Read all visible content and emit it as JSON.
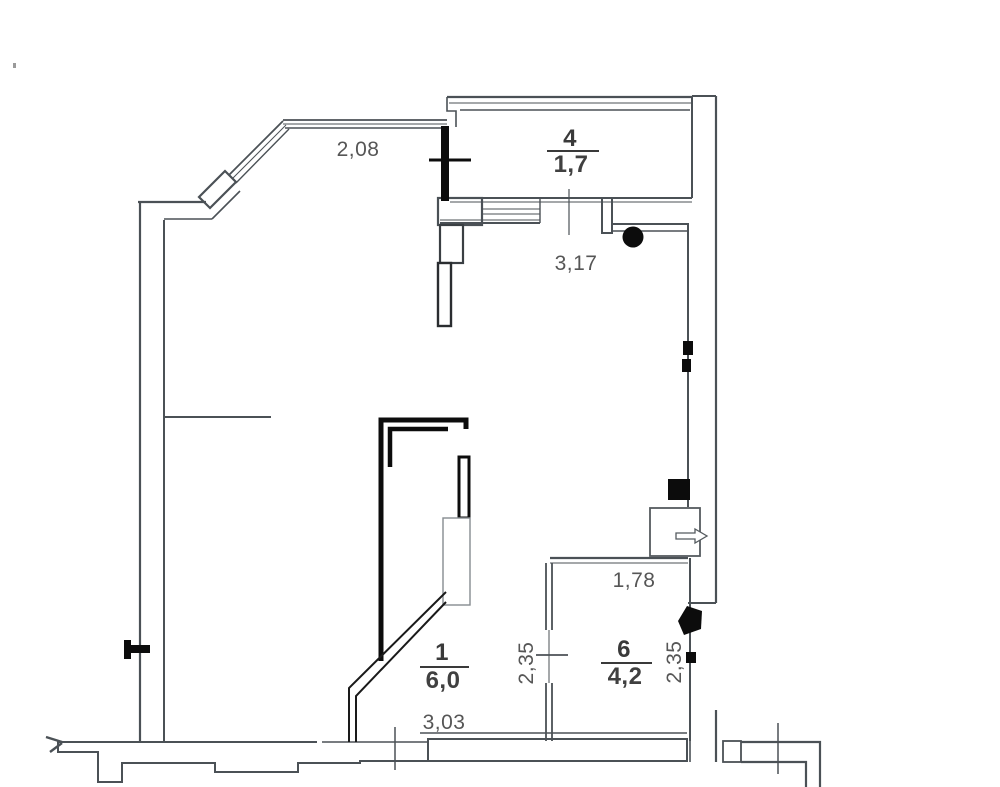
{
  "plan": {
    "type": "apartment-floor-plan-scan",
    "rooms": [
      {
        "number": "4",
        "area": "1,7"
      },
      {
        "number": "1",
        "area": "6,0"
      },
      {
        "number": "6",
        "area": "4,2"
      }
    ],
    "dimensions": {
      "bay": "2,08",
      "hall": "3,17",
      "r6_top": "1,78",
      "r1_depth": "2,35",
      "r6_depth": "2,35",
      "r1_width": "3,03"
    },
    "icons": {
      "circle_marker": "filled-circle",
      "wall_marker_small": "filled-square",
      "wall_marker_large": "filled-square",
      "pentagon_marker": "filled-pentagon",
      "panel_arrow": "right-arrow",
      "radiator_flag": "wall-flag"
    },
    "colors": {
      "wall": "#4b5156",
      "solid": "#0c0c0c",
      "text": "#565656",
      "paper": "#ffffff"
    }
  }
}
